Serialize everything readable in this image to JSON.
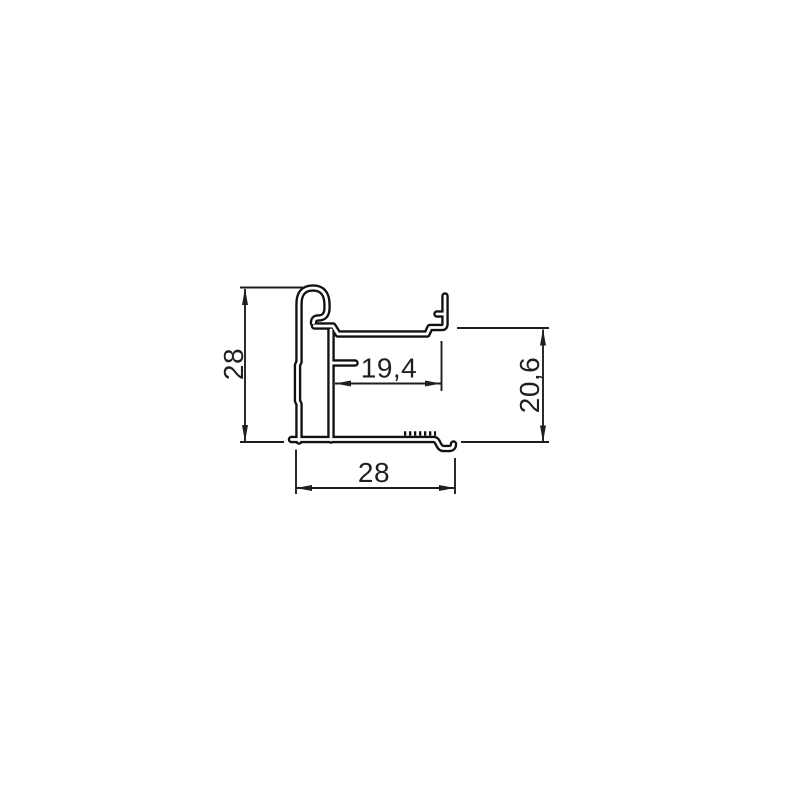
{
  "drawing": {
    "colors": {
      "background": "#ffffff",
      "profile_line": "#111111",
      "dimension_line": "#1f1f1f"
    },
    "dimensions": {
      "left_height": "28",
      "inner_width": "19,4",
      "right_height": "20,6",
      "bottom_width": "28"
    }
  }
}
